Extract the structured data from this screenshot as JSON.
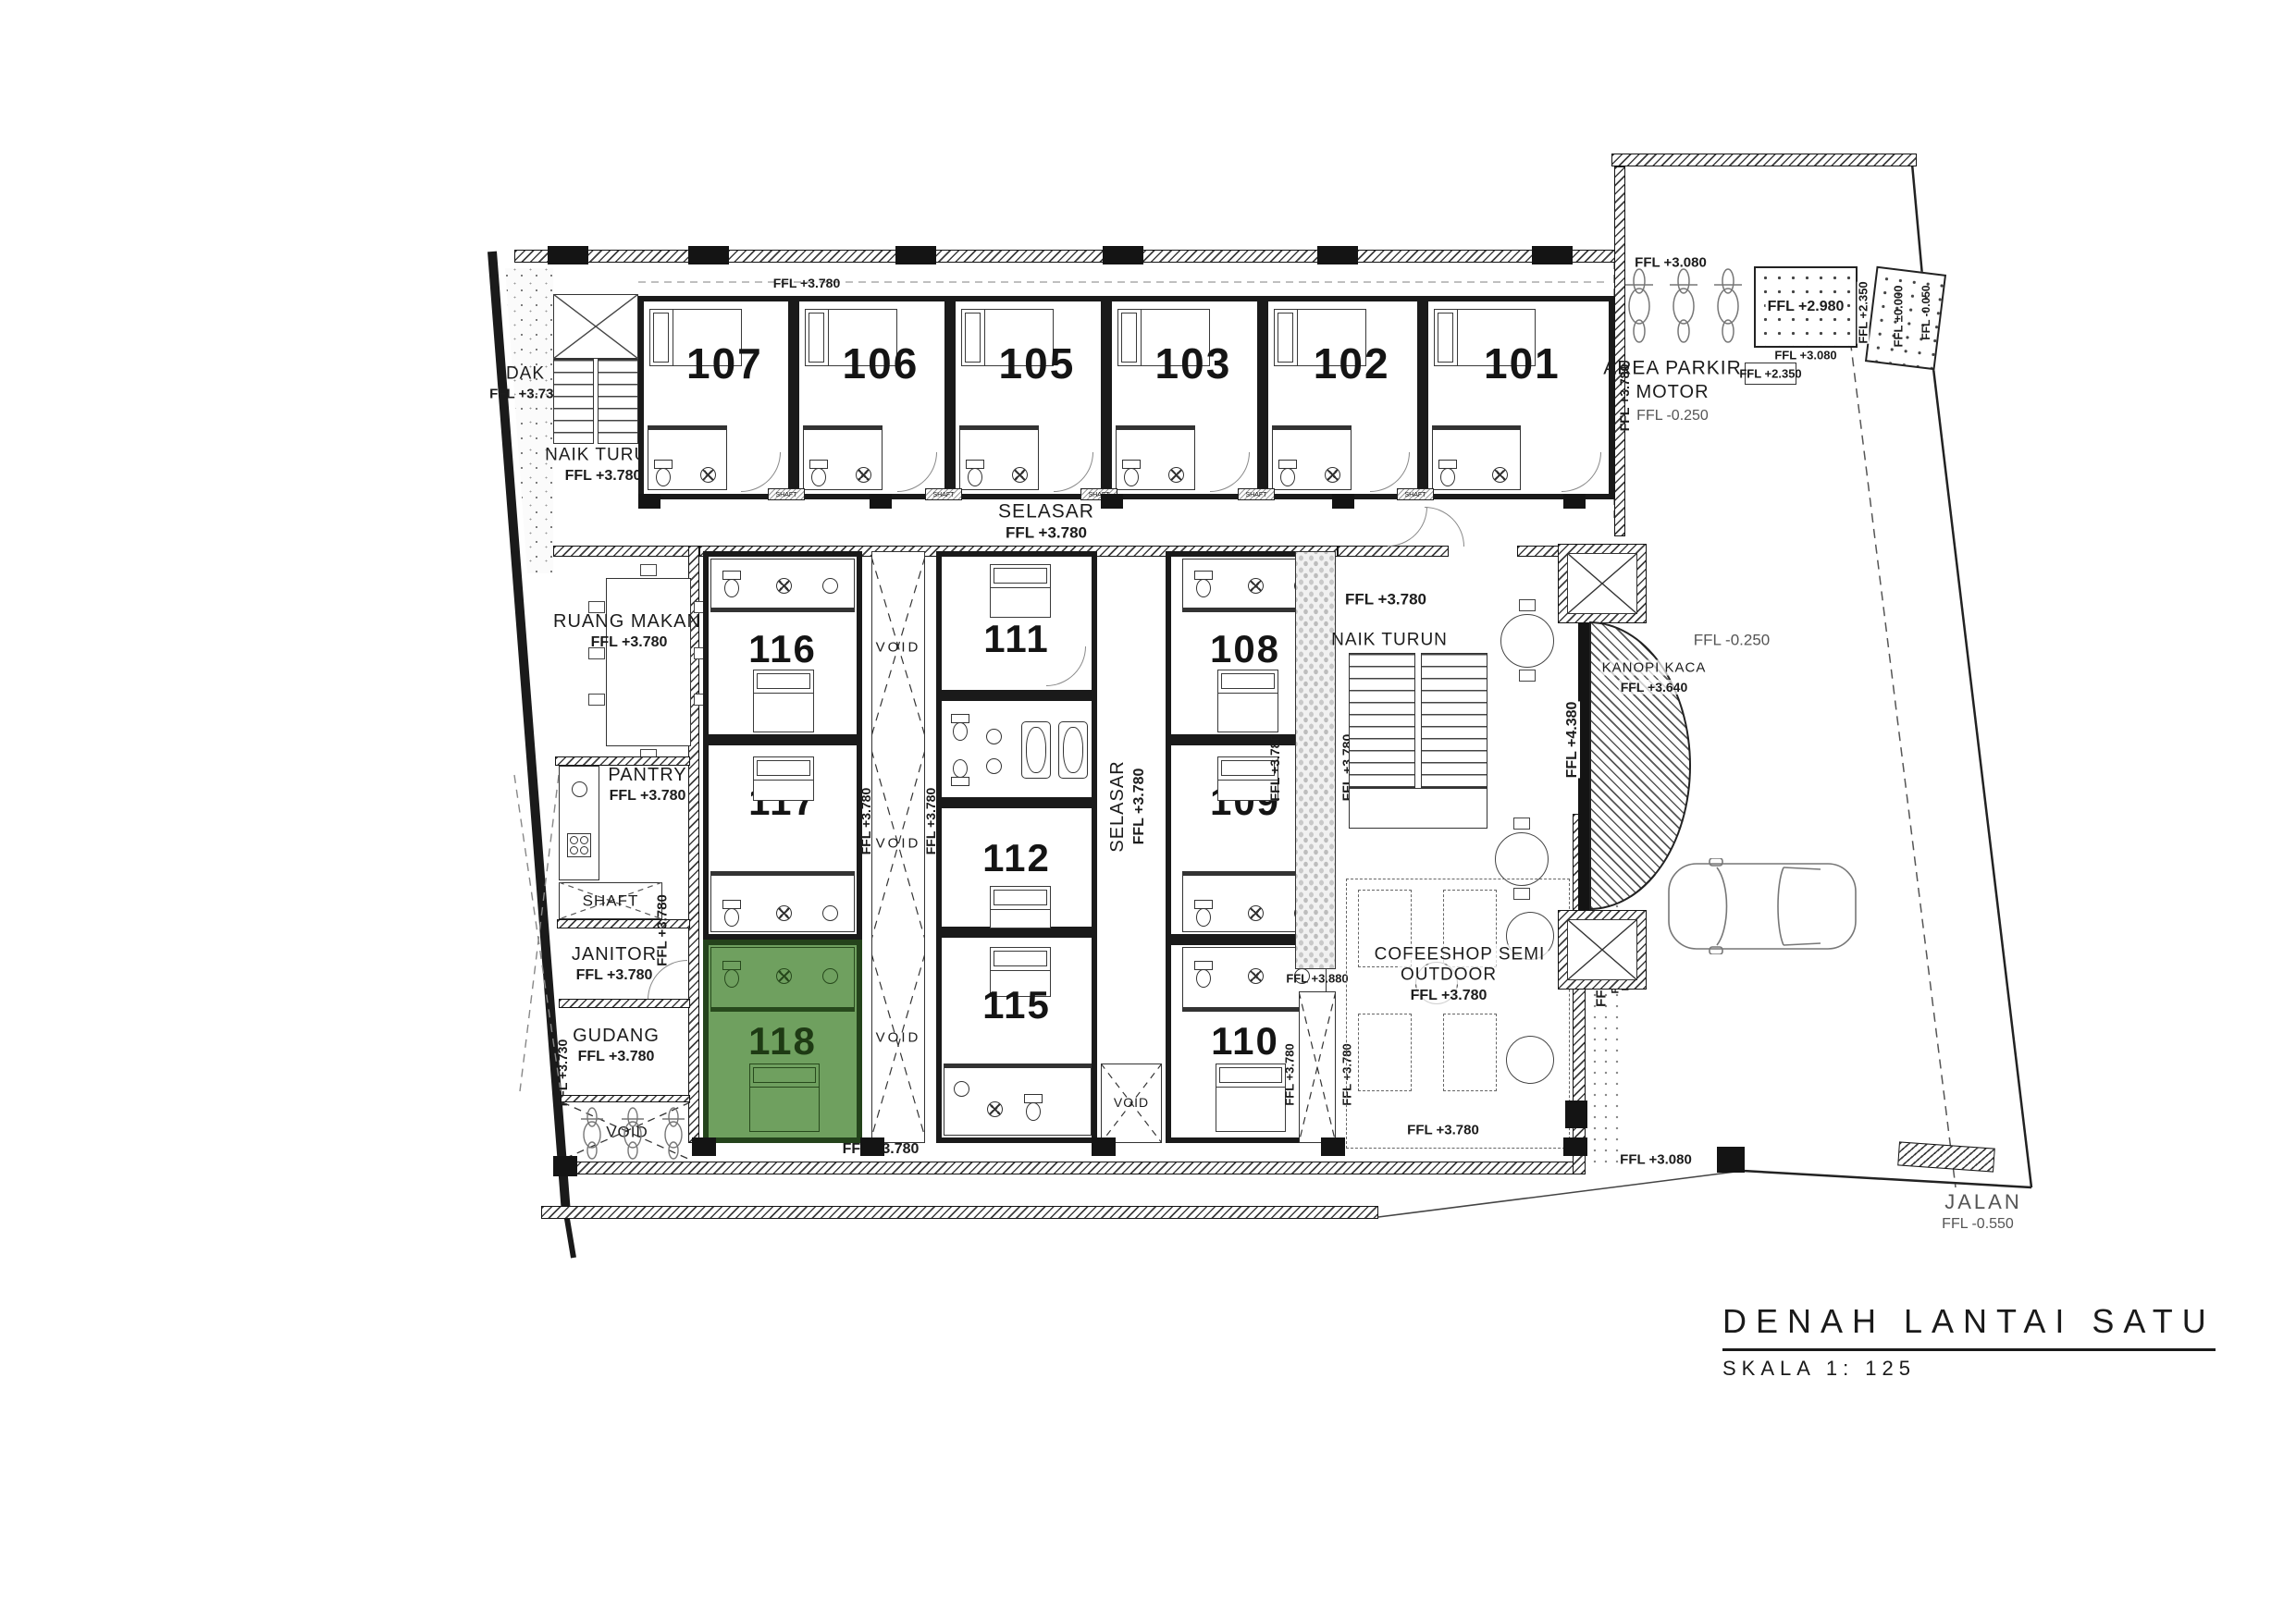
{
  "title": {
    "name": "DENAH LANTAI SATU",
    "scale": "SKALA 1: 125"
  },
  "rooms": {
    "r101": "101",
    "r102": "102",
    "r103": "103",
    "r105": "105",
    "r106": "106",
    "r107": "107",
    "r108": "108",
    "r109": "109",
    "r110": "110",
    "r111": "111",
    "r112": "112",
    "r115": "115",
    "r116": "116",
    "r117": "117",
    "r118": "118"
  },
  "areas": {
    "dak": "DAK",
    "naik_turun": "NAIK TURUN",
    "selasar": "SELASAR",
    "ruang_makan": "RUANG MAKAN",
    "pantry": "PANTRY",
    "shaft": "SHAFT",
    "janitor": "JANITOR",
    "gudang": "GUDANG",
    "void": "VOID",
    "area_parkir": "AREA PARKIR",
    "motor": "MOTOR",
    "kanopi_kaca": "KANOPI KACA",
    "coffeeshop1": "COFEESHOP SEMI",
    "coffeeshop2": "OUTDOOR",
    "jalan": "JALAN"
  },
  "levels": {
    "p3780": "FFL +3.780",
    "p3730": "FFL +3.730",
    "p3080": "FFL +3.080",
    "p2980": "FFL +2.980",
    "p2350": "FFL +2.350",
    "zero": "FFL ±0.000",
    "m0050": "FFL -0.050",
    "m0250": "FFL -0.250",
    "p4380": "FFL +4.380",
    "p4330": "FFL +4.330",
    "p3640": "FFL +3.640",
    "p3880": "FFL +3.880",
    "m0550": "FFL -0.550"
  },
  "colors": {
    "highlight": "#6fa05f",
    "wall": "#151515"
  }
}
